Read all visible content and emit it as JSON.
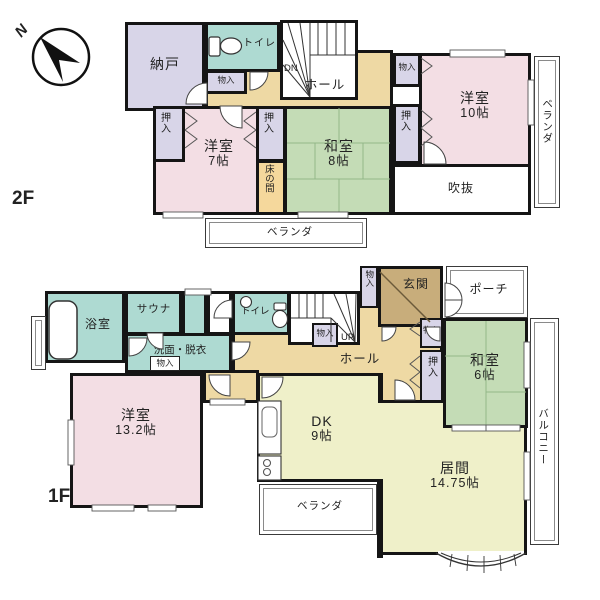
{
  "compass": {
    "north_label": "N"
  },
  "shared_labels": {
    "closet": "押入",
    "storage": "物入",
    "toilet": "トイレ",
    "hall": "ホール",
    "veranda": "ベランダ",
    "balcony": "バルコニー"
  },
  "floor2": {
    "floor_label": "2F",
    "stair_label": "DN",
    "rooms": {
      "nando": "納戸",
      "yoshitsu7": {
        "name": "洋室",
        "size": "7帖"
      },
      "washitsu8": {
        "name": "和室",
        "size": "8帖"
      },
      "tokonoma": "床の間",
      "yoshitsu10": {
        "name": "洋室",
        "size": "10帖"
      },
      "fukinuke": "吹抜"
    }
  },
  "floor1": {
    "floor_label": "1F",
    "stair_label": "UP",
    "rooms": {
      "bath": "浴室",
      "sauna": "サウナ",
      "senmen": "洗面・脱衣",
      "genkan": "玄関",
      "porch": "ポーチ",
      "yoshitsu13": {
        "name": "洋室",
        "size": "13.2帖"
      },
      "washitsu6": {
        "name": "和室",
        "size": "6帖"
      },
      "dk": {
        "name": "DK",
        "size": "9帖"
      },
      "ima": {
        "name": "居間",
        "size": "14.75帖"
      }
    }
  },
  "colors": {
    "wall": "#151515",
    "western_room": "#f3dee4",
    "tatami_room": "#c4dcb6",
    "wet_area": "#aedad2",
    "closet": "#d8d5e8",
    "hall": "#eed9a4",
    "entrance": "#c8ad7b",
    "tokonoma": "#f5d89c",
    "ldk": "#eff0c9",
    "void": "#ffffff"
  }
}
